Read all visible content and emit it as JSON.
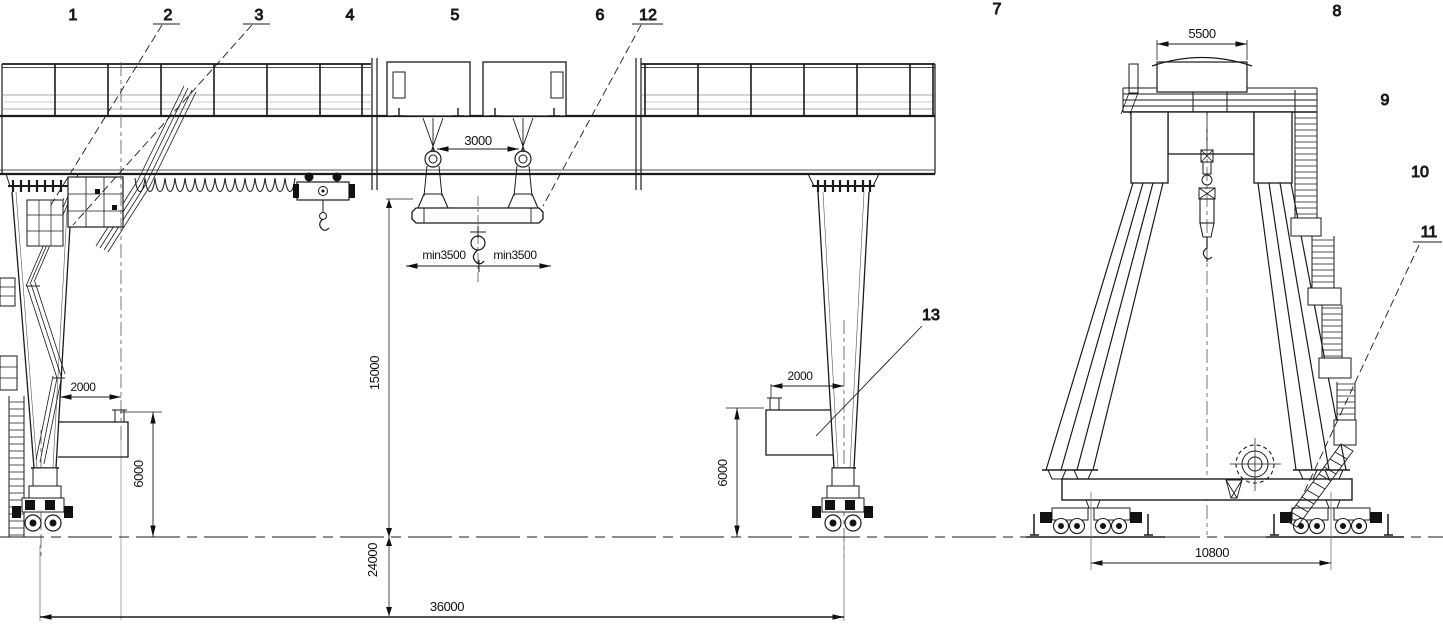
{
  "callouts": {
    "n1": "1",
    "n2": "2",
    "n3": "3",
    "n4": "4",
    "n5": "5",
    "n6": "6",
    "n7": "7",
    "n8": "8",
    "n9": "9",
    "n10": "10",
    "n11": "11",
    "n12": "12",
    "n13": "13"
  },
  "dimensions": {
    "hook_gauge": "3000",
    "hook_min_left": "min3500",
    "hook_min_right": "min3500",
    "lifting_height": "15000",
    "clearance_height": "24000",
    "span": "36000",
    "outreach_left": "2000",
    "outreach_right": "2000",
    "leg_clearance_left": "6000",
    "leg_clearance_right": "6000",
    "trolley_top_width": "5500",
    "bogie_wheelbase": "10800"
  }
}
